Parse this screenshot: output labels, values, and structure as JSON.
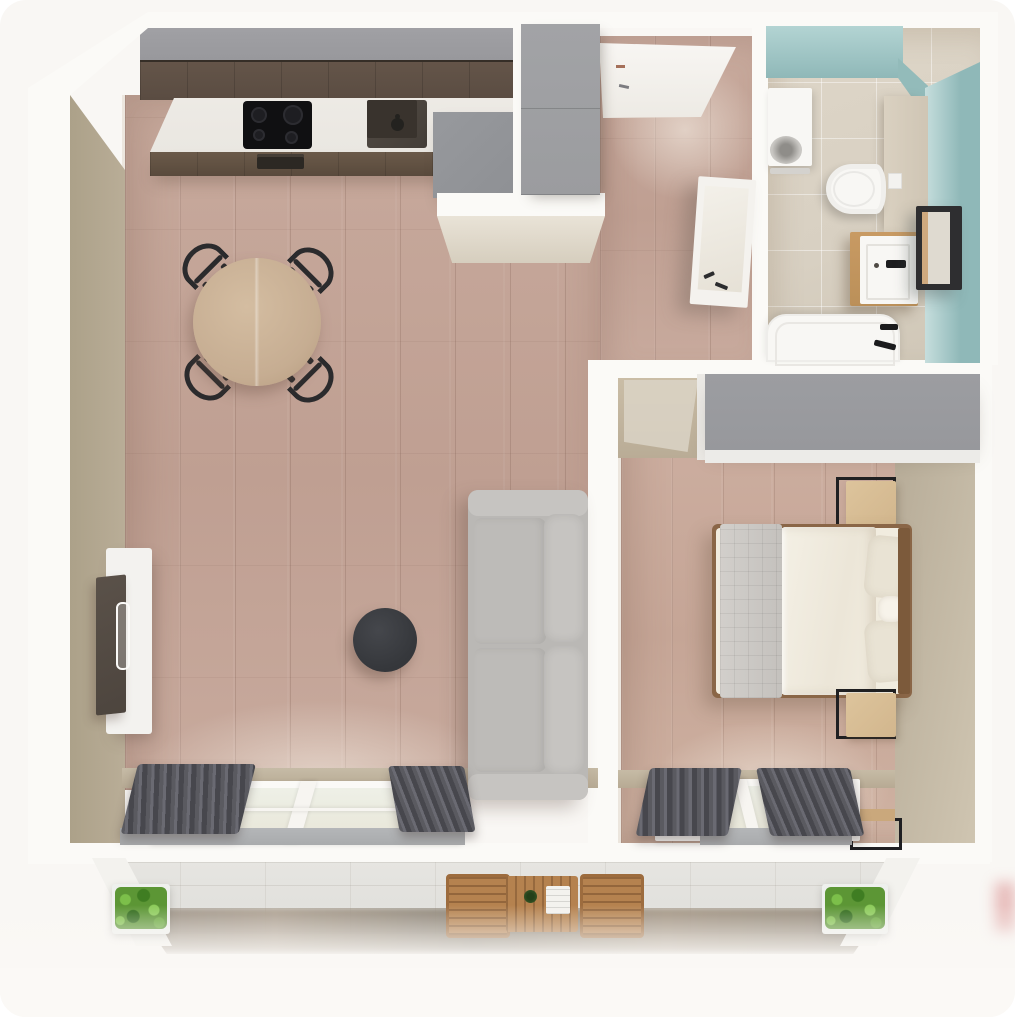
{
  "scene": {
    "kind": "3d-rendered-floor-plan-top-view",
    "apartment_type": "one-bedroom apartment with balcony",
    "text_visible_in_image": "none"
  },
  "palette": {
    "bg": "#f9f7f4",
    "wallw": "#fbfaf7",
    "face": "#b1a691",
    "face2": "#c8bda9",
    "floor1": "#c8aa9d",
    "floor2": "#bf9f92",
    "kgray": "#98989c",
    "kwoodU": "#5a4c42",
    "kwoodL": "#6b5a4a",
    "counter": "#eae7e1",
    "hob": "#101012",
    "sink": "#443e38",
    "tunit": "#8e9094",
    "hward": "#9b9c9f",
    "sofa": "#bab8b5",
    "sofac": "#c6c4c1",
    "ctable": "#35373b",
    "tvu": "#f3f2ef",
    "tvs": "#4d453e",
    "dtable": "#c6ad92",
    "chair": "#2b2b2d",
    "curt1": "#47474d",
    "curt2": "#5a5a60",
    "glass": "#eef0e7",
    "sill": "#a9abad",
    "bfloor": "#d8d0c2",
    "teal": "#8fb8b8",
    "tealL": "#b3d4d3",
    "fix": "#f8f7f4",
    "vanity": "#bb9059",
    "mirror": "#2e2e30",
    "duvet": "#f1ecdf",
    "quilt": "#cbc8c4",
    "pillow": "#e9e3d4",
    "bedframe": "#8a6647",
    "nstand": "#d2b68d",
    "bward": "#97989c",
    "btile": "#dfdeda",
    "ground": "#8b8174",
    "plant": "#5c9635",
    "owood": "#b5824f",
    "redblur": "#d98b8b"
  },
  "rooms": {
    "living_kitchen": {
      "floor": "light pink-brown wood planks",
      "furniture": [
        "kitchen run with gray top band and dark wood cabinets",
        "white stone counter",
        "black 4-burner hob",
        "dark undermount sink with faucet",
        "oven vent",
        "gray tall unit",
        "round wood dining table",
        "four black spindle chairs",
        "round black coffee table",
        "gray three-seat sofa",
        "white tv cabinet",
        "dark tv panel leaning on wall",
        "balcony glass door with gray curtains"
      ]
    },
    "hallway": {
      "floor": "wood planks",
      "furniture": [
        "white entrance door",
        "gray tall wardrobe",
        "white leaning mirror"
      ]
    },
    "bathroom": {
      "walls": "teal",
      "floor": "beige tiles",
      "furniture": [
        "washing machine",
        "wall-hung toilet with flush plate",
        "wood vanity with white basin and black tap",
        "black framed mirror",
        "white bathtub with black fittings"
      ]
    },
    "bedroom": {
      "floor": "wood planks",
      "furniture": [
        "gray wardrobe",
        "double bed with cream duvet and gray quilted runner",
        "two pillows and neck roll",
        "two wood nightstands with black metal frames",
        "window with gray curtains",
        "small black-frame desk"
      ]
    },
    "balcony": {
      "floor": "light gray tiles",
      "furniture": [
        "two green planter boxes",
        "wood slat table with plant pot and tray",
        "two wood chairs"
      ]
    }
  }
}
